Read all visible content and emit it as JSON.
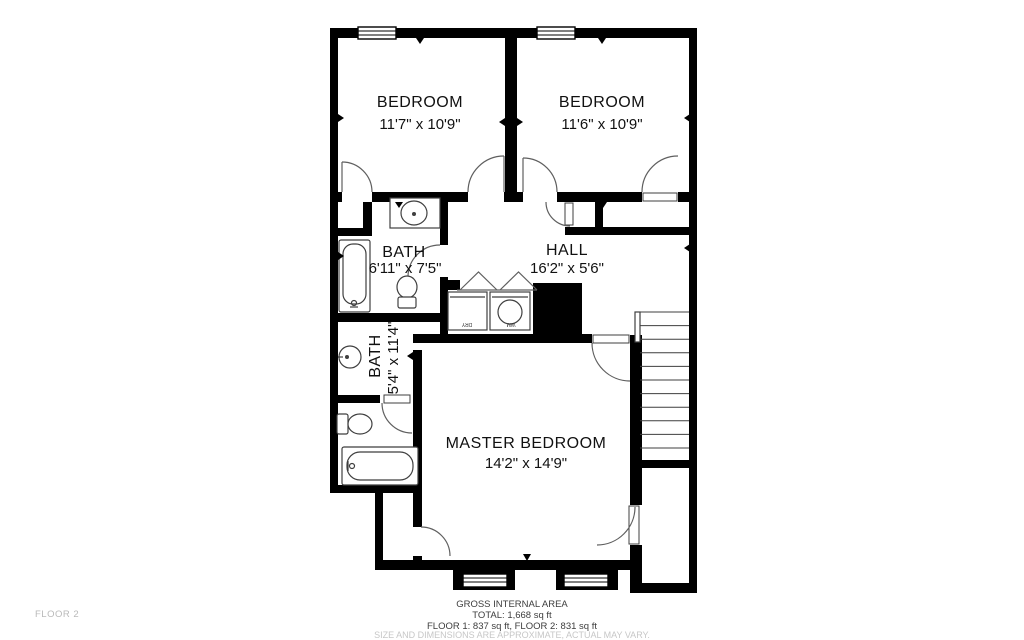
{
  "floor_label": "FLOOR 2",
  "rooms": {
    "bedroom1": {
      "name": "BEDROOM",
      "dims": "11'7\" x 10'9\""
    },
    "bedroom2": {
      "name": "BEDROOM",
      "dims": "11'6\" x 10'9\""
    },
    "bath1": {
      "name": "BATH",
      "dims": "6'11\" x 7'5\""
    },
    "hall": {
      "name": "HALL",
      "dims": "16'2\" x 5'6\""
    },
    "bath2": {
      "name": "BATH",
      "dims": "5'4\" x 11'4\""
    },
    "master": {
      "name": "MASTER BEDROOM",
      "dims": "14'2\" x 14'9\""
    }
  },
  "appliances": {
    "dryer": "DRY",
    "washer": "WM"
  },
  "footer": {
    "line1": "GROSS INTERNAL AREA",
    "line2": "TOTAL: 1,668 sq ft",
    "line3": "FLOOR 1: 837 sq ft, FLOOR 2: 831 sq ft",
    "disclaimer": "SIZE AND DIMENSIONS ARE APPROXIMATE, ACTUAL MAY VARY."
  },
  "colors": {
    "wall": "#000000",
    "fixture_line": "#3f3f3f",
    "text": "#111111",
    "muted_text": "#c7c7c7",
    "floor_tag": "#b9b9b9"
  }
}
